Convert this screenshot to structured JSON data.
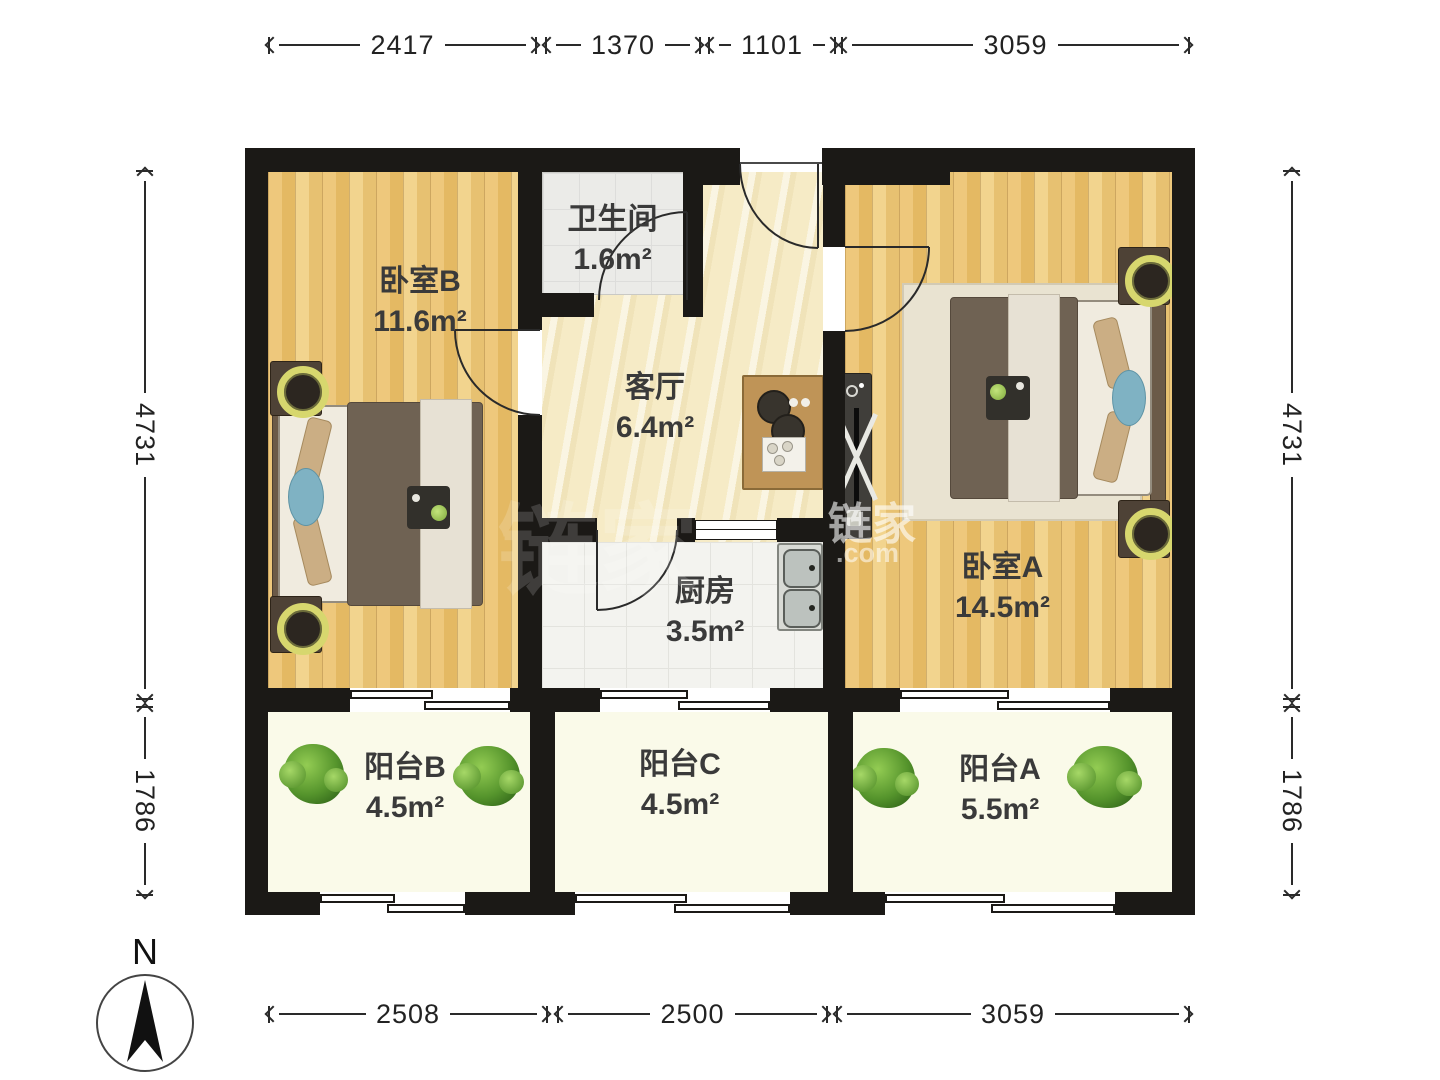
{
  "plan": {
    "rooms": [
      {
        "id": "bedroom-b",
        "name": "卧室B",
        "area": "11.6m²"
      },
      {
        "id": "bathroom",
        "name": "卫生间",
        "area": "1.6m²"
      },
      {
        "id": "living",
        "name": "客厅",
        "area": "6.4m²"
      },
      {
        "id": "kitchen",
        "name": "厨房",
        "area": "3.5m²"
      },
      {
        "id": "bedroom-a",
        "name": "卧室A",
        "area": "14.5m²"
      },
      {
        "id": "balcony-b",
        "name": "阳台B",
        "area": "4.5m²"
      },
      {
        "id": "balcony-c",
        "name": "阳台C",
        "area": "4.5m²"
      },
      {
        "id": "balcony-a",
        "name": "阳台A",
        "area": "5.5m²"
      }
    ],
    "dimensions": {
      "top": [
        "2417",
        "1370",
        "1101",
        "3059"
      ],
      "bottom": [
        "2508",
        "2500",
        "3059"
      ],
      "left": [
        "4731",
        "1786"
      ],
      "right": [
        "4731",
        "1786"
      ]
    },
    "compass": {
      "label": "N"
    },
    "watermark": {
      "primary": "链家",
      "secondary": ".com"
    }
  }
}
